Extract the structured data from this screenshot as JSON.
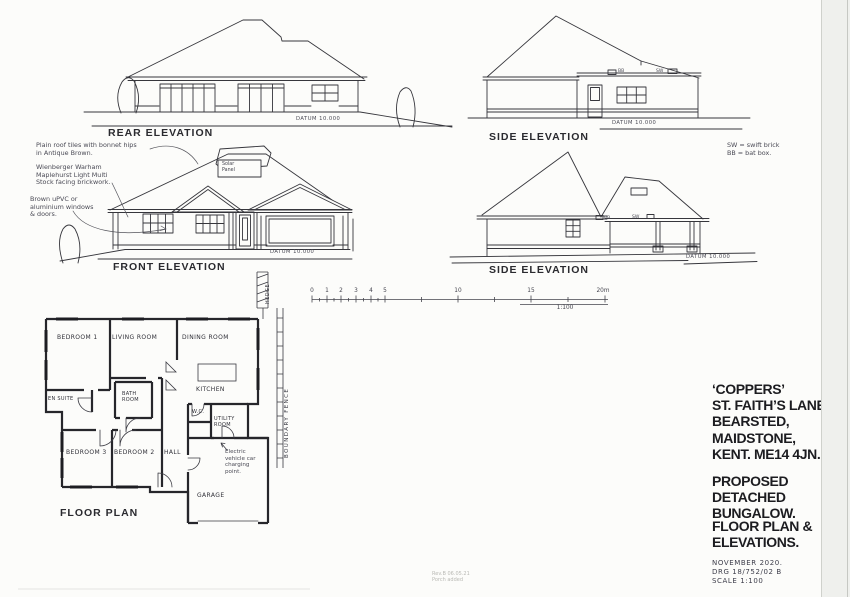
{
  "elevations": {
    "rear": {
      "title": "REAR ELEVATION",
      "datum": "DATUM 10.000"
    },
    "side_upper": {
      "title": "SIDE ELEVATION",
      "datum": "DATUM 10.000",
      "bat_box": "BB",
      "swift_brick": "SW"
    },
    "front": {
      "title": "FRONT ELEVATION",
      "datum": "DATUM 10.000",
      "solar_panel": [
        "Solar",
        "Panel"
      ]
    },
    "side_lower": {
      "title": "SIDE ELEVATION",
      "datum": "DATUM 10.000",
      "bat_box": "BB",
      "swift_brick": "SW"
    }
  },
  "notes": {
    "roof_tiles": [
      "Plain roof tiles with bonnet hips",
      "in Antique Brown."
    ],
    "brickwork": [
      "Wienberger Warham",
      "Maplehurst Light Multi",
      "Stock facing brickwork."
    ],
    "windows": [
      "Brown uPVC or",
      "aluminium windows",
      "& doors."
    ],
    "legend": [
      "SW = swift brick",
      "BB = bat box."
    ],
    "ev_charging": [
      "Electric",
      "vehicle car",
      "charging",
      "point."
    ],
    "revision": [
      "Rev.B 06.05.21",
      "Porch added"
    ]
  },
  "scale_bar": {
    "ticks": [
      "0",
      "1",
      "2",
      "3",
      "4",
      "5",
      "10",
      "15",
      "20m"
    ],
    "ratio": "1:100"
  },
  "floor_plan": {
    "title": "FLOOR PLAN",
    "rooms": {
      "bedroom1": "BEDROOM 1",
      "living": "LIVING ROOM",
      "dining": "DINING ROOM",
      "kitchen": "KITCHEN",
      "ensuite": "EN SUITE",
      "bath": [
        "BATH",
        "ROOM"
      ],
      "wc": "W.C.",
      "utility": [
        "UTILITY",
        "ROOM"
      ],
      "bedroom3": "BEDROOM 3",
      "bedroom2": "BEDROOM 2",
      "hall": "HALL",
      "garage": "GARAGE"
    },
    "site": {
      "boundary_fence": "BOUNDARY FENCE",
      "hedge": "HEDGE"
    }
  },
  "title_block": {
    "address": [
      "‘COPPERS’",
      "ST. FAITH’S LANE,",
      "BEARSTED,",
      "MAIDSTONE,",
      "KENT. ME14 4JN."
    ],
    "project": [
      "PROPOSED DETACHED",
      "BUNGALOW."
    ],
    "sheet": [
      "FLOOR PLAN &",
      "ELEVATIONS."
    ],
    "date": "NOVEMBER 2020.",
    "drawing_no": "DRG 18/752/02 B",
    "scale": "SCALE 1:100"
  }
}
